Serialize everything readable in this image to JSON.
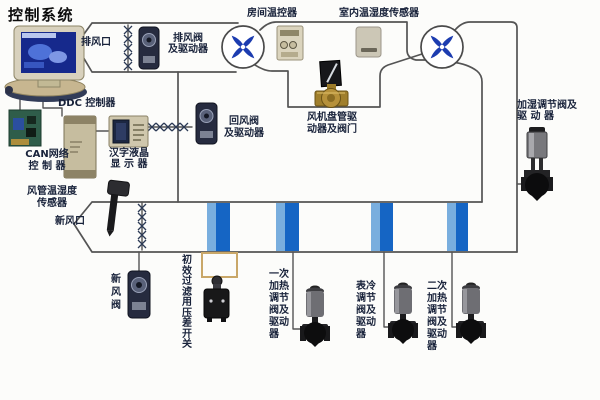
{
  "title": "控制系统",
  "labels": {
    "exhaust_vent": "排风口",
    "exhaust_valve": "排风阀\n及驱动器",
    "room_thermostat": "房间温控器",
    "indoor_temp_humidity_sensor": "室内温湿度传感器",
    "ddc_controller": "DDC 控制器",
    "can_network_controller": "CAN网络\n控 制 器",
    "lcd_display": "汉字液晶\n显 示 器",
    "return_air_valve": "回风阀\n及驱动器",
    "fan_coil_driver_valve": "风机盘管驱\n动器及阀门",
    "humidify_valve": "加湿调节阀及\n驱  动  器",
    "duct_temp_humidity_sensor": "风管温湿度\n传感器",
    "fresh_air_vent": "新风口",
    "fresh_air_valve": "新风阀",
    "filter_pressure_switch": "初效过滤用压差开关",
    "primary_heating_valve": "一次加热调节阀及驱动器",
    "cooling_valve": "表冷调节阀及驱动器",
    "secondary_heating_valve": "二次加热调节阀及驱动器"
  },
  "icons": {
    "fan": "pinwheel-cross-fan",
    "damper": "cross-hatched-damper-line",
    "pipe": "blue-water-pipe"
  },
  "colors": {
    "line": "#545454",
    "label_text": "#18223a",
    "fan_blade_blue": "#1c3cb0",
    "pipe_blue": "#1565c4",
    "pipe_light_blue": "#79aede",
    "brass_valve": "#a8842e",
    "device_beige": "#c6bd9f",
    "filter_box_tan": "#c9a768"
  }
}
